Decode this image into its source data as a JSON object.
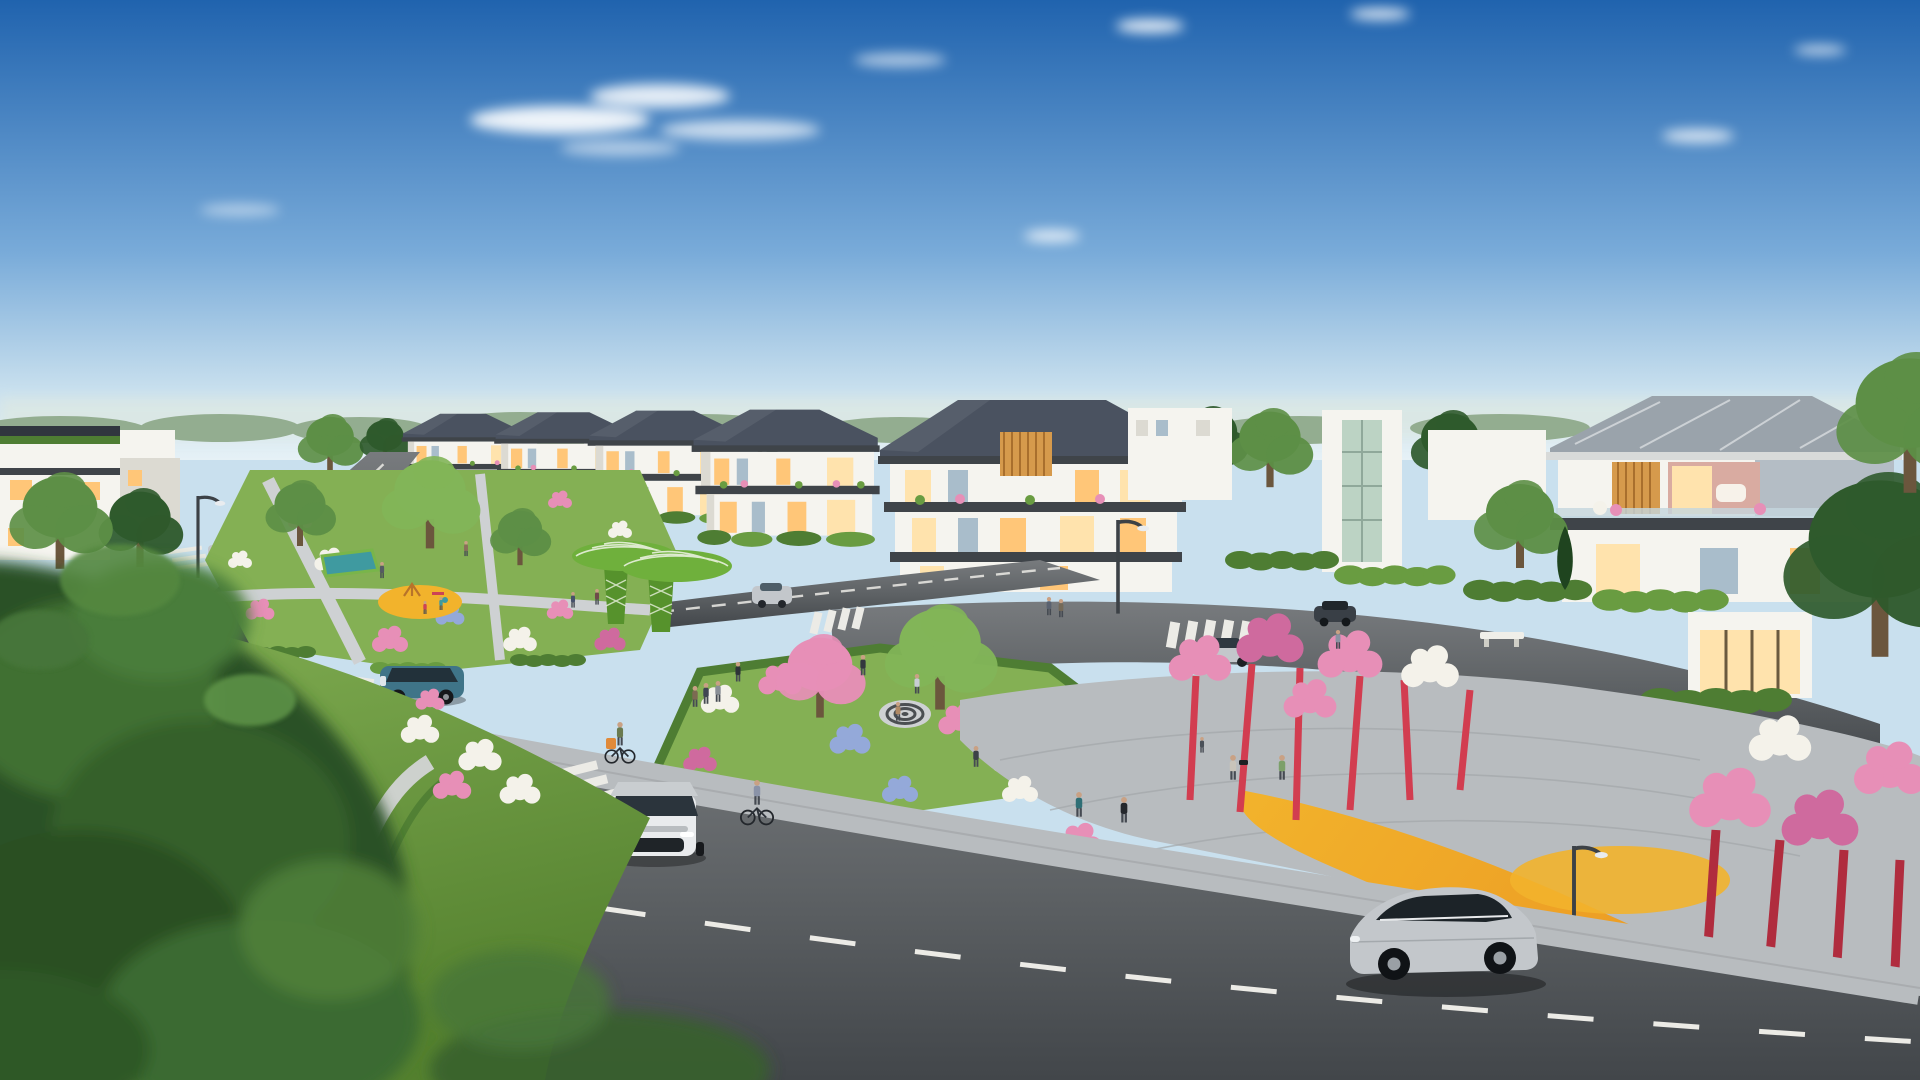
{
  "scene": {
    "type": "photorealistic architectural rendering",
    "description": "Aerial three-quarter view of a modern suburban residential development at golden hour: a row of white three-storey villas with dark hipped roofs and warm lit windows, a landscaped central park with leaf-shaped green canopy sculptures, flower gardens, curving asphalt roads with zebra crossings, cars, cyclists and pedestrians, and a foreground of blurred lush greenery; right side features red-trunk blossom trees over an orange-yellow path.",
    "time_of_day": "late afternoon, clear blue sky with wispy clouds",
    "text_on_screen": ""
  },
  "objects": {
    "buildings": [
      "row-villa-1",
      "row-villa-2",
      "row-villa-3",
      "row-villa-4",
      "center-villa-with-wood-slats",
      "white-apartment-block",
      "glass-stair-tower",
      "white-block-2",
      "right-villa",
      "storefront",
      "distant-modern-houses",
      "distant-gable-house"
    ],
    "vehicles": [
      "teal-suv",
      "white-suv-front",
      "silver-suv-side",
      "dark-sedan",
      "gray-sedan",
      "silver-hatch",
      "small-gray-car",
      "small-red-car",
      "silver-car-mid",
      "white-car-left",
      "white-car-distant",
      "silver-sedan-right",
      "dark-suv-right"
    ],
    "people": [
      "pedestrians",
      "cyclists",
      "joggers",
      "children-on-playground",
      "photographer",
      "person-waving"
    ],
    "landscape": [
      "left-park",
      "playground-yellow",
      "sports-court",
      "green-canopy-sculptures",
      "center-garden-island",
      "spiral-paving",
      "red-trunk-blossom-trees",
      "yellow-garden-path",
      "flower-beds",
      "foreground-hill",
      "stone-path",
      "blurred-foliage"
    ]
  },
  "palette": {
    "sky_top": "#2063ae",
    "sky_mid": "#79abd9",
    "sky_low": "#c9e0ee",
    "sky_horizon": "#e6f1f6",
    "cloud": "#ffffff",
    "haze": "#dce8e3",
    "tree_distant": "#93ad90",
    "tree_mid": "#5d8f46",
    "tree_dark": "#2f5a2c",
    "tree_deep": "#1f441f",
    "tree_light": "#82b558",
    "lawn": "#84b054",
    "lawn_light": "#a8cb72",
    "lawn_dark": "#54812f",
    "hedge": "#4e7d33",
    "hedge_light": "#699c41",
    "roof_dark": "#4a5260",
    "roof_edge": "#30363e",
    "roof_light": "#9aa3ab",
    "fascia": "#3f4449",
    "wall_white": "#f5f4ef",
    "wall_shadow": "#dcdad2",
    "wall_gray": "#b4bdc5",
    "win_warm": "#ffc678",
    "win_glow": "#ffe3ad",
    "win_cool": "#a9bdcb",
    "win_dark": "#4e5e68",
    "wood": "#d69a4c",
    "glass_rail": "#c4d6dd",
    "asphalt": "#5e6265",
    "asphalt_light": "#787b7e",
    "asphalt_dark": "#42464a",
    "marking": "#ecebe6",
    "paver": "#b8bcbf",
    "paver_light": "#ced1d3",
    "stone": "#cdd1cd",
    "fl_pink": "#e78fb7",
    "fl_deep": "#cf6a9e",
    "fl_white": "#f4f2ea",
    "fl_blue": "#94a9d9",
    "fl_yellow": "#e9c94e",
    "yellow": "#f2b32c",
    "orange": "#ea9320",
    "red_pole": "#d23d50",
    "red_deep": "#b02c3e",
    "canopy": "#6fb03c",
    "canopy_dark": "#56922c",
    "vein": "#e9f1de",
    "car_teal": "#3f7488",
    "car_silver": "#c3c7cb",
    "car_white": "#e9ebed",
    "car_dark": "#393f46",
    "car_gray": "#90969b",
    "skin": "#c9a184",
    "cloth_dark": "#363b42",
    "trunk": "#6b563d",
    "pole": "#3c4146"
  }
}
